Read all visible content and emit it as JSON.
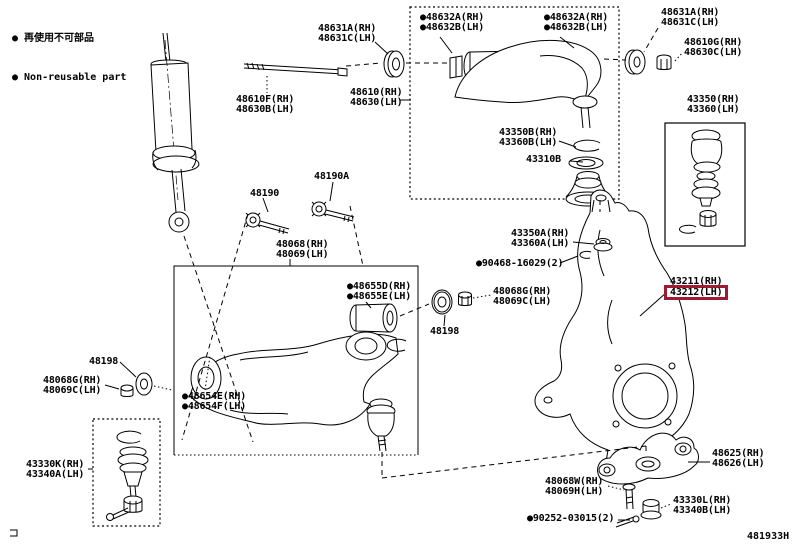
{
  "page": {
    "width": 796,
    "height": 549,
    "background": "#ffffff",
    "line_color": "#000000"
  },
  "legend": {
    "line1": "● 再使用不可部品",
    "line2": "● Non-reusable part"
  },
  "figure_code": "481933H",
  "highlight": {
    "part": "43212(LH)",
    "color": "#9e1b32"
  },
  "labels": [
    {
      "name": "callout-48631a-left",
      "x": 318,
      "y": 24,
      "interactable": true,
      "lines": [
        {
          "text": "48631A(RH)"
        },
        {
          "text": "48631C(LH)"
        }
      ]
    },
    {
      "name": "callout-48632-left",
      "x": 420,
      "y": 13,
      "interactable": true,
      "lines": [
        {
          "text": "●48632A(RH)"
        },
        {
          "text": "●48632B(LH)"
        }
      ]
    },
    {
      "name": "callout-48632-right",
      "x": 544,
      "y": 13,
      "interactable": true,
      "lines": [
        {
          "text": "●48632A(RH)"
        },
        {
          "text": "●48632B(LH)"
        }
      ]
    },
    {
      "name": "callout-48631a-right",
      "x": 661,
      "y": 8,
      "interactable": true,
      "lines": [
        {
          "text": "48631A(RH)"
        },
        {
          "text": "48631C(LH)"
        }
      ]
    },
    {
      "name": "callout-48610g",
      "x": 684,
      "y": 38,
      "interactable": true,
      "lines": [
        {
          "text": "48610G(RH)"
        },
        {
          "text": "48630C(LH)"
        }
      ]
    },
    {
      "name": "callout-48610f",
      "x": 236,
      "y": 95,
      "interactable": true,
      "lines": [
        {
          "text": "48610F(RH)"
        },
        {
          "text": "48630B(LH)"
        }
      ]
    },
    {
      "name": "callout-48610",
      "x": 350,
      "y": 88,
      "interactable": true,
      "lines": [
        {
          "text": "48610(RH)"
        },
        {
          "text": "48630(LH)"
        }
      ]
    },
    {
      "name": "callout-43350",
      "x": 687,
      "y": 95,
      "interactable": true,
      "lines": [
        {
          "text": "43350(RH)"
        },
        {
          "text": "43360(LH)"
        }
      ]
    },
    {
      "name": "callout-43350b",
      "x": 499,
      "y": 128,
      "interactable": true,
      "lines": [
        {
          "text": "43350B(RH)"
        },
        {
          "text": "43360B(LH)"
        }
      ]
    },
    {
      "name": "callout-43310b",
      "x": 526,
      "y": 155,
      "interactable": true,
      "lines": [
        {
          "text": "43310B"
        }
      ]
    },
    {
      "name": "callout-48190a",
      "x": 314,
      "y": 172,
      "interactable": true,
      "lines": [
        {
          "text": "48190A"
        }
      ]
    },
    {
      "name": "callout-48190",
      "x": 250,
      "y": 189,
      "interactable": true,
      "lines": [
        {
          "text": "48190"
        }
      ]
    },
    {
      "name": "callout-48068",
      "x": 276,
      "y": 240,
      "interactable": true,
      "lines": [
        {
          "text": "48068(RH)"
        },
        {
          "text": "48069(LH)"
        }
      ]
    },
    {
      "name": "callout-43350a",
      "x": 511,
      "y": 229,
      "interactable": true,
      "lines": [
        {
          "text": "43350A(RH)"
        },
        {
          "text": "43360A(LH)"
        }
      ]
    },
    {
      "name": "callout-90468",
      "x": 476,
      "y": 259,
      "interactable": true,
      "lines": [
        {
          "text": "●90468-16029(2)"
        }
      ]
    },
    {
      "name": "callout-48655",
      "x": 347,
      "y": 282,
      "interactable": true,
      "lines": [
        {
          "text": "●48655D(RH)"
        },
        {
          "text": "●48655E(LH)"
        }
      ]
    },
    {
      "name": "callout-48068g-right",
      "x": 493,
      "y": 287,
      "interactable": true,
      "lines": [
        {
          "text": "48068G(RH)"
        },
        {
          "text": "48069C(LH)"
        }
      ]
    },
    {
      "name": "callout-43211-43212",
      "x": 670,
      "y": 277,
      "interactable": true,
      "lines": [
        {
          "text": "43211(RH)"
        },
        {
          "text": "43212(LH)",
          "highlight": true
        }
      ]
    },
    {
      "name": "callout-48198-right",
      "x": 430,
      "y": 327,
      "interactable": true,
      "lines": [
        {
          "text": "48198"
        }
      ]
    },
    {
      "name": "callout-48198-left",
      "x": 89,
      "y": 357,
      "interactable": true,
      "lines": [
        {
          "text": "48198"
        }
      ]
    },
    {
      "name": "callout-48068g-left",
      "x": 43,
      "y": 376,
      "interactable": true,
      "lines": [
        {
          "text": "48068G(RH)"
        },
        {
          "text": "48069C(LH)"
        }
      ]
    },
    {
      "name": "callout-48654",
      "x": 182,
      "y": 392,
      "interactable": true,
      "lines": [
        {
          "text": "●48654E(RH)"
        },
        {
          "text": "●48654F(LH)"
        }
      ]
    },
    {
      "name": "callout-43330k",
      "x": 26,
      "y": 460,
      "interactable": true,
      "lines": [
        {
          "text": "43330K(RH)"
        },
        {
          "text": "43340A(LH)"
        }
      ]
    },
    {
      "name": "callout-48625",
      "x": 712,
      "y": 449,
      "interactable": true,
      "lines": [
        {
          "text": "48625(RH)"
        },
        {
          "text": "48626(LH)"
        }
      ]
    },
    {
      "name": "callout-48068w",
      "x": 545,
      "y": 477,
      "interactable": true,
      "lines": [
        {
          "text": "48068W(RH)"
        },
        {
          "text": "48069H(LH)"
        }
      ]
    },
    {
      "name": "callout-43330l",
      "x": 673,
      "y": 496,
      "interactable": true,
      "lines": [
        {
          "text": "43330L(RH)"
        },
        {
          "text": "43340B(LH)"
        }
      ]
    },
    {
      "name": "callout-90252",
      "x": 527,
      "y": 514,
      "interactable": true,
      "lines": [
        {
          "text": "●90252-03015(2)"
        }
      ]
    }
  ]
}
